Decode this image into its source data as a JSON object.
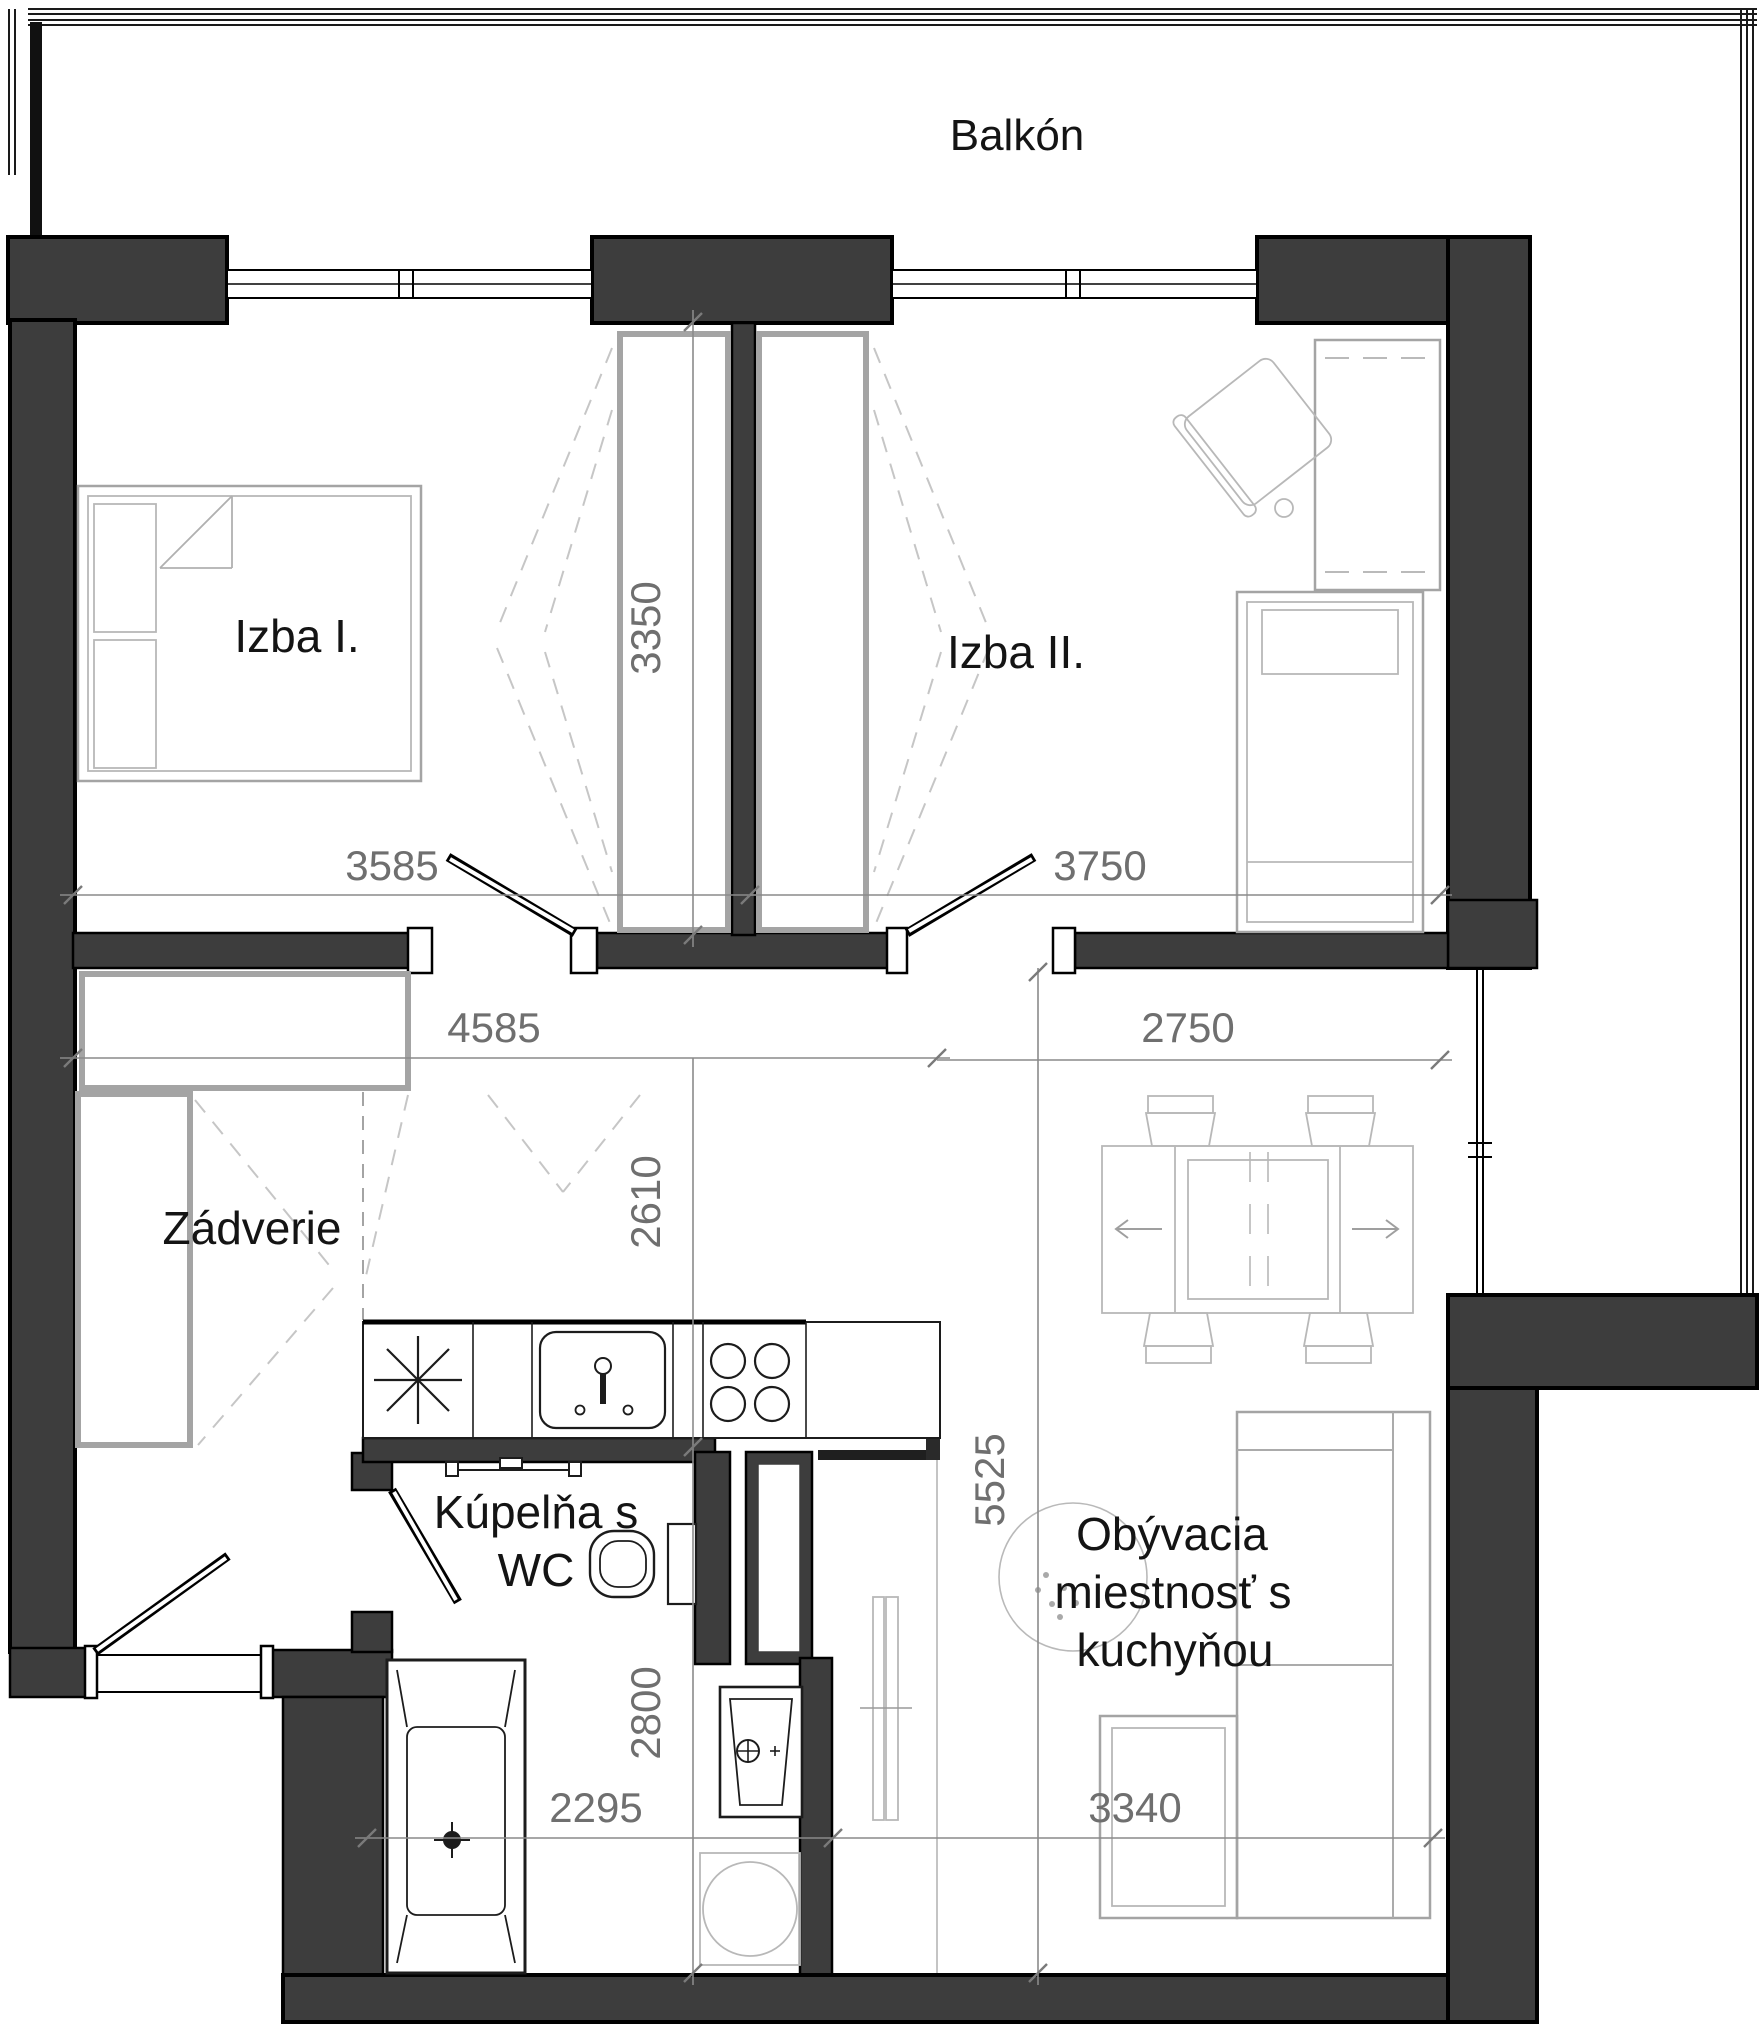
{
  "plan": {
    "balcony_label": "Balkón",
    "rooms": {
      "izba1": {
        "label": "Izba I."
      },
      "izba2": {
        "label": "Izba II."
      },
      "zadverie": {
        "label": "Zádverie"
      },
      "kupelna": {
        "label_line1": "Kúpelňa s",
        "label_line2": "WC"
      },
      "obyvacia": {
        "label_line1": "Obývacia",
        "label_line2": "miestnosť s",
        "label_line3": "kuchyňou"
      }
    },
    "dimensions_mm": {
      "d3350": {
        "value": "3350"
      },
      "d3585": {
        "value": "3585"
      },
      "d3750": {
        "value": "3750"
      },
      "d4585": {
        "value": "4585"
      },
      "d2750": {
        "value": "2750"
      },
      "d2610": {
        "value": "2610"
      },
      "d2800": {
        "value": "2800"
      },
      "d5525": {
        "value": "5525"
      },
      "d2295": {
        "value": "2295"
      },
      "d3340": {
        "value": "3340"
      }
    },
    "colors": {
      "wall_fill": "#3d3d3d",
      "wall_outline": "#000000",
      "furniture_gray": "#a4a4a4",
      "dimension_gray": "#6f6f6f",
      "background": "#ffffff"
    },
    "furniture_icons": [
      "double-bed-icon",
      "wardrobe-icon",
      "single-bed-icon",
      "desk-icon",
      "chair-icon",
      "kitchen-counter-icon",
      "appliance-asterisk-icon",
      "kitchen-sink-icon",
      "stove-icon",
      "toilet-icon",
      "towel-rail-icon",
      "washbasin-icon",
      "washing-machine-icon",
      "bathtub-icon",
      "dining-table-icon",
      "dining-chair-icon",
      "sofa-icon",
      "tv-bench-icon",
      "ceiling-light-icon",
      "door-leaf-icon",
      "window-icon",
      "balcony-railing-icon"
    ]
  }
}
